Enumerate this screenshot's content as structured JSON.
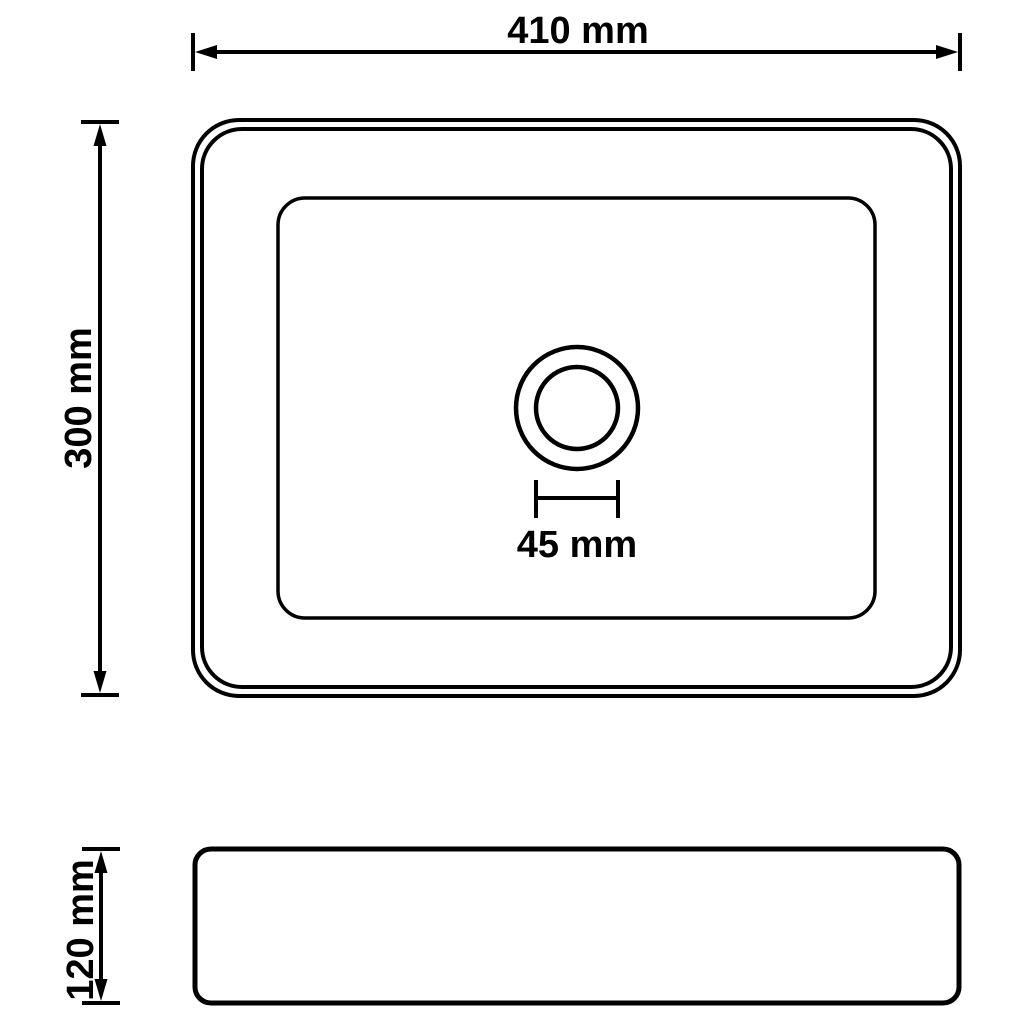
{
  "diagram": {
    "type": "technical-drawing",
    "subject": "rectangular washbasin with drain hole, top view and side view",
    "background_color": "#ffffff",
    "line_color": "#000000",
    "dimensions": {
      "width_label": "410 mm",
      "height_label": "300 mm",
      "drain_label": "45 mm",
      "depth_label": "120 mm"
    }
  }
}
